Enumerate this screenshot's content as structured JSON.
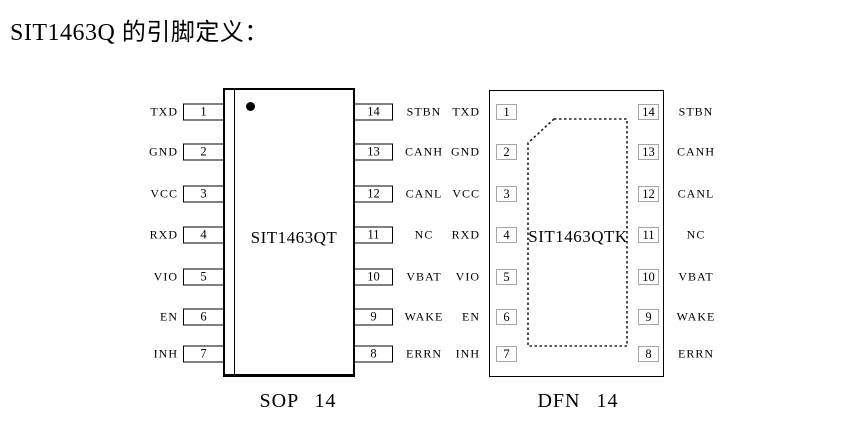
{
  "title": "SIT1463Q 的引脚定义：",
  "colors": {
    "ink": "#000000",
    "dfn_pin_border": "#a6a6a6",
    "background": "#ffffff"
  },
  "sop": {
    "caption": "SOP 14",
    "chip_label": "SIT1463QT",
    "pin1_marker": "filled-dot",
    "rows": [
      {
        "l_label": "TXD",
        "l_num": "1",
        "r_num": "14",
        "r_label": "STBN"
      },
      {
        "l_label": "GND",
        "l_num": "2",
        "r_num": "13",
        "r_label": "CANH"
      },
      {
        "l_label": "VCC",
        "l_num": "3",
        "r_num": "12",
        "r_label": "CANL"
      },
      {
        "l_label": "RXD",
        "l_num": "4",
        "r_num": "11",
        "r_label": "NC"
      },
      {
        "l_label": "VIO",
        "l_num": "5",
        "r_num": "10",
        "r_label": "VBAT"
      },
      {
        "l_label": "EN",
        "l_num": "6",
        "r_num": "9",
        "r_label": "WAKE"
      },
      {
        "l_label": "INH",
        "l_num": "7",
        "r_num": "8",
        "r_label": "ERRN"
      }
    ]
  },
  "dfn": {
    "caption": "DFN 14",
    "chip_label": "SIT1463QTK",
    "exposed_pad": "dashed-outline-chamfered-top-left",
    "rows": [
      {
        "l_label": "TXD",
        "l_num": "1",
        "r_num": "14",
        "r_label": "STBN"
      },
      {
        "l_label": "GND",
        "l_num": "2",
        "r_num": "13",
        "r_label": "CANH"
      },
      {
        "l_label": "VCC",
        "l_num": "3",
        "r_num": "12",
        "r_label": "CANL"
      },
      {
        "l_label": "RXD",
        "l_num": "4",
        "r_num": "11",
        "r_label": "NC"
      },
      {
        "l_label": "VIO",
        "l_num": "5",
        "r_num": "10",
        "r_label": "VBAT"
      },
      {
        "l_label": "EN",
        "l_num": "6",
        "r_num": "9",
        "r_label": "WAKE"
      },
      {
        "l_label": "INH",
        "l_num": "7",
        "r_num": "8",
        "r_label": "ERRN"
      }
    ]
  }
}
